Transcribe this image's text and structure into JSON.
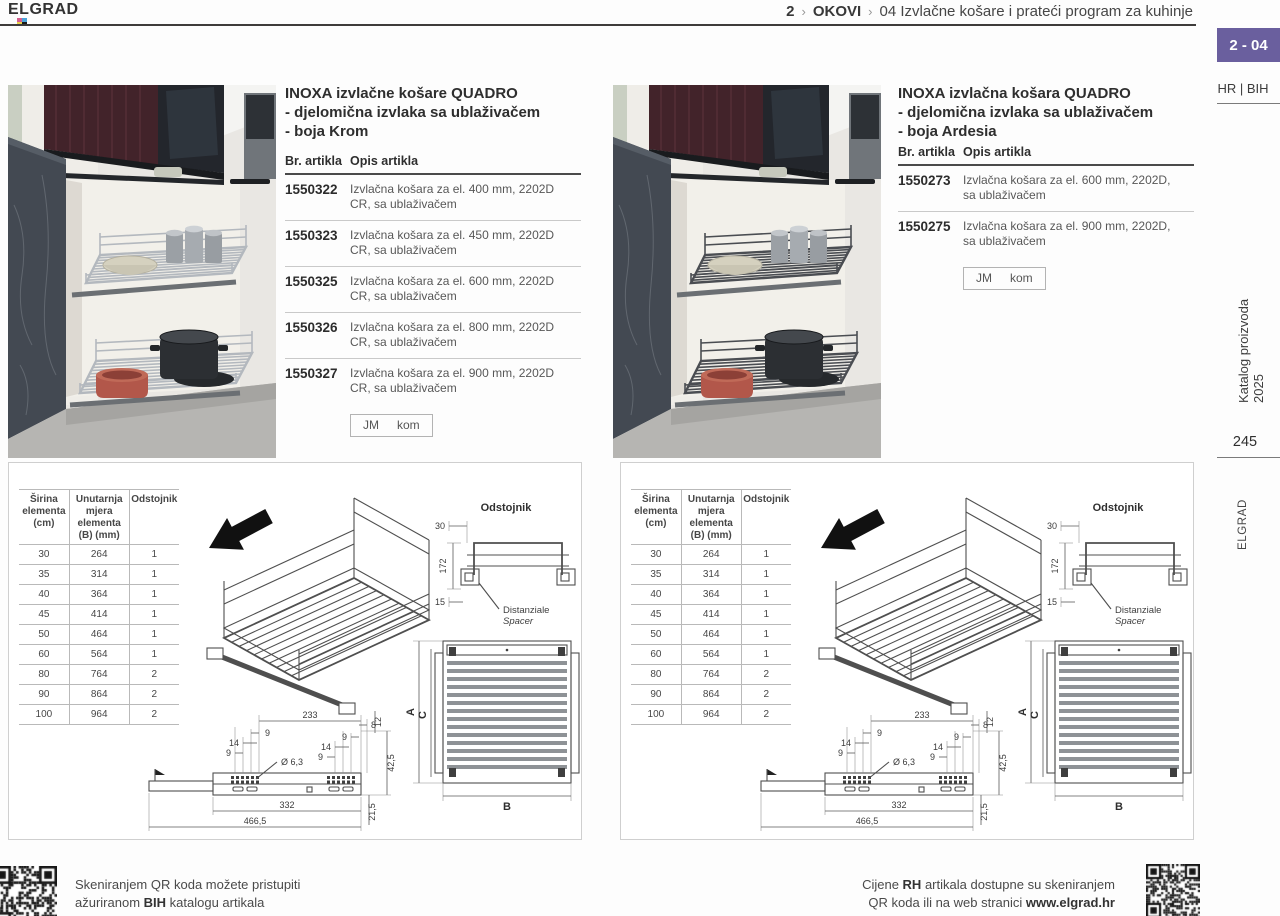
{
  "colors": {
    "accent": "#6a5f9e",
    "wire_chrome": "#b3b8be",
    "wire_ardesia": "#4a4d52"
  },
  "header": {
    "logo": "ELGRAD",
    "breadcrumb": {
      "part1": "2",
      "sep1": "›",
      "part2": "OKOVI",
      "sep2": "›",
      "part3_num": "04",
      "part3_label": "Izvlačne košare i prateći program za kuhinje"
    },
    "badge": "2 - 04"
  },
  "sidebar": {
    "lang": "HR | BIH",
    "catalog": "Katalog proizvoda 2025",
    "page_number": "245",
    "brand_vertical": "ELGRAD"
  },
  "products": [
    {
      "title1": "INOXA izvlačne košare QUADRO",
      "title2": "- djelomična izvlaka sa ublaživačem",
      "title3": "- boja Krom",
      "col_code": "Br. artikla",
      "col_desc": "Opis artikla",
      "rows": [
        {
          "code": "1550322",
          "desc": "Izvlačna košara za el. 400 mm, 2202D CR, sa ublaživačem"
        },
        {
          "code": "1550323",
          "desc": "Izvlačna košara za el. 450 mm, 2202D CR, sa ublaživačem"
        },
        {
          "code": "1550325",
          "desc": "Izvlačna košara za el. 600 mm, 2202D CR, sa ublaživačem"
        },
        {
          "code": "1550326",
          "desc": "Izvlačna košara za el. 800 mm, 2202D CR, sa ublaživačem"
        },
        {
          "code": "1550327",
          "desc": "Izvlačna košara za el. 900 mm, 2202D CR, sa ublaživačem"
        }
      ],
      "jm_label": "JM",
      "jm_value": "kom"
    },
    {
      "title1": "INOXA izvlačna košara QUADRO",
      "title2": "- djelomična izvlaka sa ublaživačem",
      "title3": "- boja Ardesia",
      "col_code": "Br. artikla",
      "col_desc": "Opis artikla",
      "rows": [
        {
          "code": "1550273",
          "desc": "Izvlačna košara za el. 600 mm, 2202D, sa ublaživačem"
        },
        {
          "code": "1550275",
          "desc": "Izvlačna košara za el. 900 mm, 2202D, sa ublaživačem"
        }
      ],
      "jm_label": "JM",
      "jm_value": "kom"
    }
  ],
  "dimension_table": {
    "header_col1": "Širina elementa (cm)",
    "header_col2": "Unutarnja mjera elementa (B) (mm)",
    "header_col3": "Odstojnik",
    "rows": [
      [
        "30",
        "264",
        "1"
      ],
      [
        "35",
        "314",
        "1"
      ],
      [
        "40",
        "364",
        "1"
      ],
      [
        "45",
        "414",
        "1"
      ],
      [
        "50",
        "464",
        "1"
      ],
      [
        "60",
        "564",
        "1"
      ],
      [
        "80",
        "764",
        "2"
      ],
      [
        "90",
        "864",
        "2"
      ],
      [
        "100",
        "964",
        "2"
      ]
    ]
  },
  "drawing": {
    "title": "Odstojnik",
    "spacer1": "Distanziale",
    "spacer2": "Spacer",
    "dim_30": "30",
    "dim_172": "172",
    "dim_15": "15",
    "dim_233": "233",
    "dim_9": "9",
    "dim_14": "14",
    "dim_8": "8",
    "dim_diam": "Ø 6,3",
    "dim_12": "12",
    "dim_425": "42,5",
    "dim_332": "332",
    "dim_4665": "466,5",
    "dim_215": "21,5",
    "label_a": "A",
    "label_b": "B",
    "label_c": "C"
  },
  "footer": {
    "left_line1": "Skeniranjem QR koda možete pristupiti",
    "left_line2_pre": "ažuriranom ",
    "left_line2_bold": "BIH",
    "left_line2_post": " katalogu artikala",
    "right_line1_pre": "Cijene ",
    "right_line1_bold": "RH",
    "right_line1_post": " artikala dostupne su skeniranjem",
    "right_line2_pre": "QR koda ili na web stranici ",
    "right_line2_bold": "www.elgrad.hr"
  }
}
